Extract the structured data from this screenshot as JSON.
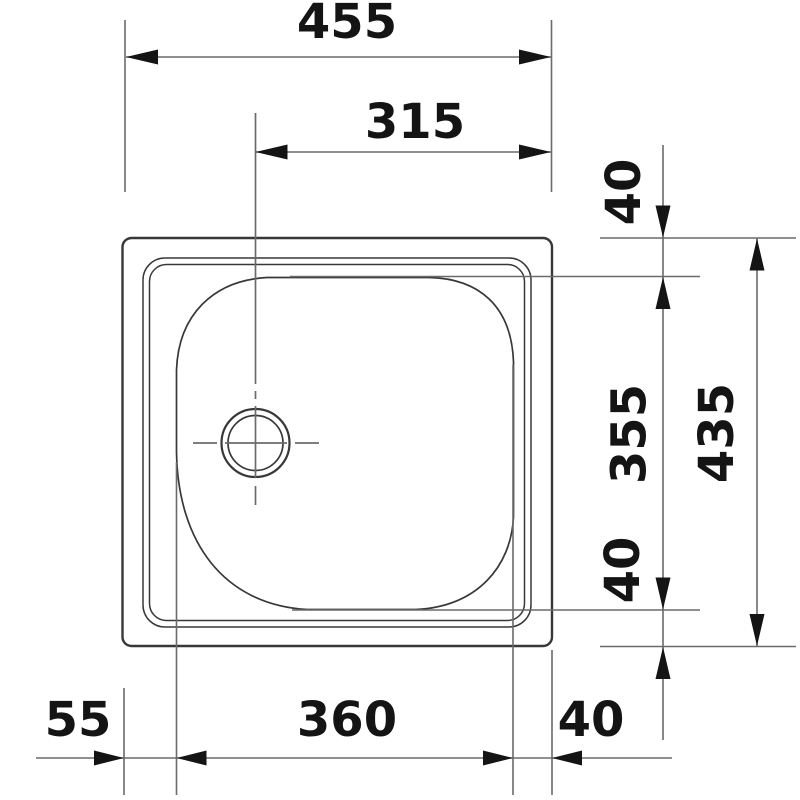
{
  "drawing": {
    "type": "technical-dimension-drawing",
    "subject": "inset kitchen sink with single bowl and drain hole, plan view",
    "units": "mm",
    "labels": {
      "overall_width": "455",
      "drain_center_to_right_edge": "315",
      "top_edge_to_bowl": "40",
      "bowl_length": "355",
      "overall_depth": "435",
      "bowl_to_bottom_edge": "40",
      "left_edge_to_bowl": "55",
      "bowl_width": "360",
      "bowl_to_right_edge": "40"
    },
    "dimensions_mm": [
      {
        "value": 455,
        "orientation": "horizontal",
        "measures": "overall sink width",
        "position": "top"
      },
      {
        "value": 315,
        "orientation": "horizontal",
        "measures": "drain centerline to right sink edge",
        "position": "top"
      },
      {
        "value": 40,
        "orientation": "vertical",
        "measures": "top sink edge to bowl edge",
        "position": "right"
      },
      {
        "value": 355,
        "orientation": "vertical",
        "measures": "bowl length front-to-back",
        "position": "right"
      },
      {
        "value": 435,
        "orientation": "vertical",
        "measures": "overall sink depth",
        "position": "right"
      },
      {
        "value": 40,
        "orientation": "vertical",
        "measures": "bowl edge to bottom sink edge",
        "position": "right"
      },
      {
        "value": 55,
        "orientation": "horizontal",
        "measures": "left sink edge to bowl edge",
        "position": "bottom"
      },
      {
        "value": 360,
        "orientation": "horizontal",
        "measures": "bowl width",
        "position": "bottom"
      },
      {
        "value": 40,
        "orientation": "horizontal",
        "measures": "bowl edge to right sink edge",
        "position": "bottom"
      }
    ],
    "colors": {
      "background": "#ffffff",
      "drawing_ink": "#383838",
      "thin_line": "#6b6b6b",
      "text_ink": "#141414"
    }
  }
}
